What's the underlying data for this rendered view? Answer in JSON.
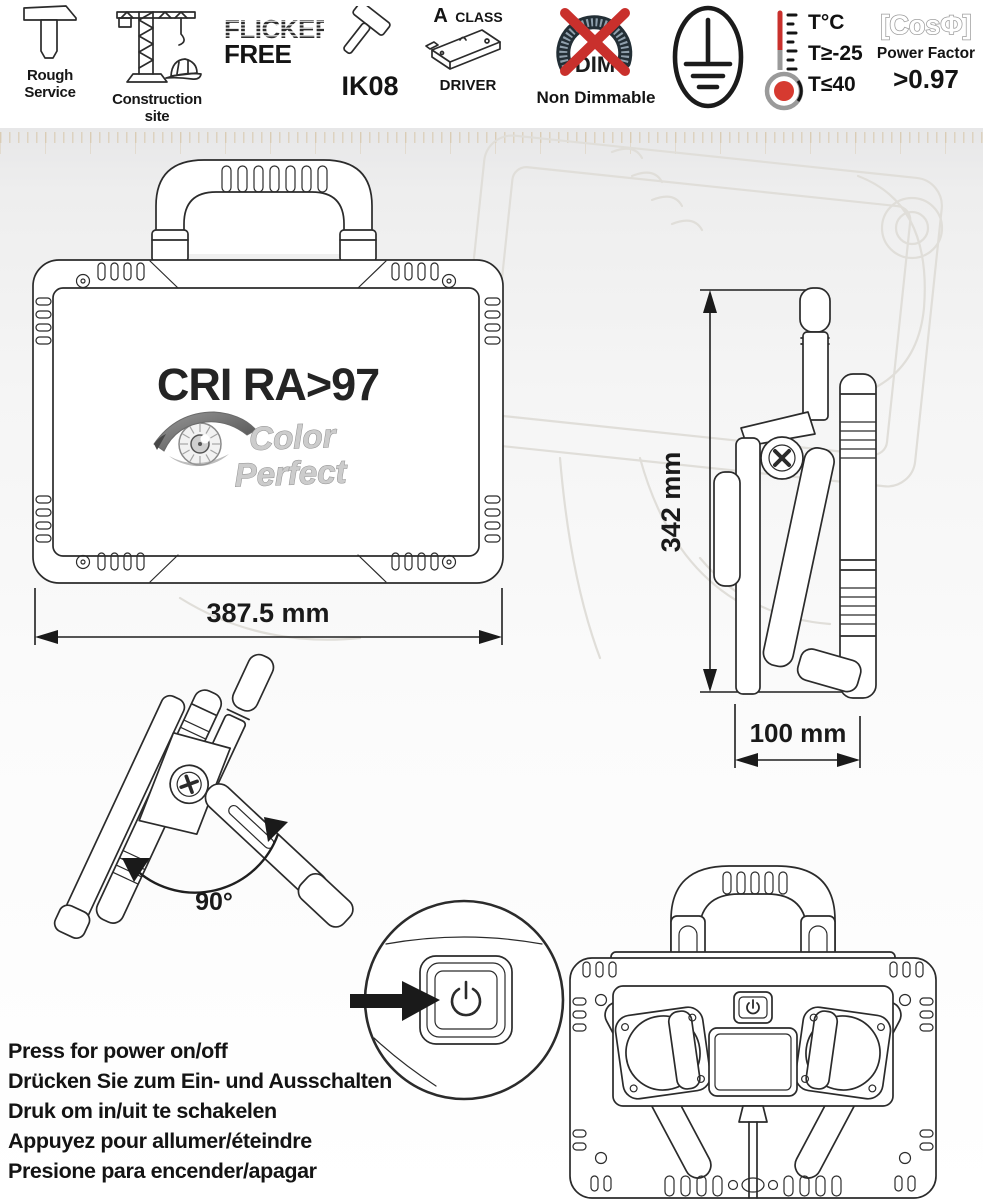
{
  "badges": {
    "rough_service": {
      "line1": "Rough",
      "line2": "Service"
    },
    "construction_site": {
      "line1": "Construction",
      "line2": "site"
    },
    "flicker_free": {
      "line1": "FLICKER",
      "line2": "FREE"
    },
    "ik08": {
      "label": "IK08"
    },
    "a_class_driver": {
      "top_a": "A",
      "top_rest": "CLASS",
      "bottom": "DRIVER"
    },
    "non_dimmable": {
      "dim": "DIM",
      "label": "Non Dimmable"
    },
    "thermometer": {
      "line1": "T°C",
      "line2": "T≥-25",
      "line3": "T≤40"
    },
    "power_factor": {
      "formula": "[CosΦ]",
      "label": "Power Factor",
      "value": ">0.97"
    }
  },
  "front_view": {
    "cri": "CRI RA>97",
    "logo_line1": "Color",
    "logo_line2": "Perfect",
    "width_dim": "387.5 mm"
  },
  "side_view": {
    "height_dim": "342 mm",
    "depth_dim": "100 mm"
  },
  "tilt_view": {
    "angle_label": "90°"
  },
  "instructions": [
    "Press for power on/off",
    "Drücken Sie zum Ein- und Ausschalten",
    "Druk om in/uit te schakelen",
    "Appuyez pour allumer/éteindre",
    "Presione para encender/apagar"
  ],
  "colors": {
    "ink": "#2b2b2b",
    "red": "#c9302c",
    "steel": "#8fa0ad",
    "silver": "#cccccc",
    "watermark": "#e0ded9"
  }
}
